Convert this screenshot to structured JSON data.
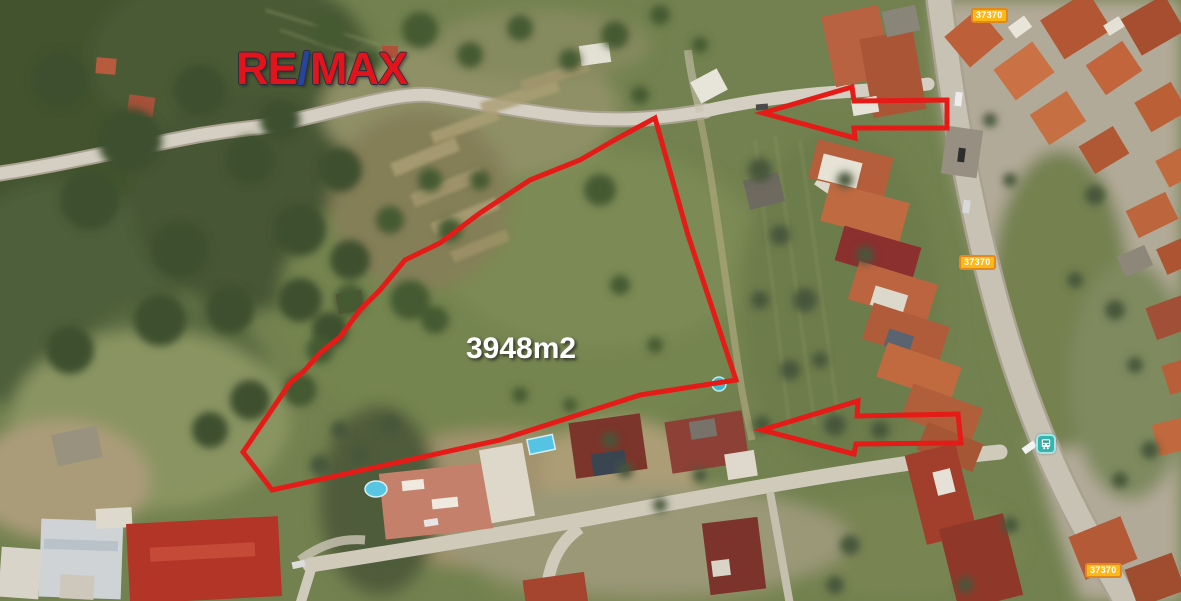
{
  "map_title": "satellite view of land plot for sale",
  "logo": {
    "re": "RE",
    "slash": "/",
    "max": "MAX"
  },
  "plot": {
    "area_label": "3948m2"
  },
  "road_badges": [
    {
      "label": "37370"
    },
    {
      "label": "37370"
    },
    {
      "label": "37370"
    }
  ],
  "icons": {
    "bus_stop": "transit-bus"
  },
  "colors": {
    "annotation_red": "#e41b17",
    "remax_red": "#e2131b",
    "remax_blue": "#27459c",
    "badge_yellow": "#fbb817",
    "badge_border": "#e1891e",
    "bus_teal": "#35b3ac",
    "field_green": "#72814f",
    "forest_green": "#42522f",
    "road_gray": "#c8c2b4",
    "roof_terracotta": "#bc6242"
  }
}
